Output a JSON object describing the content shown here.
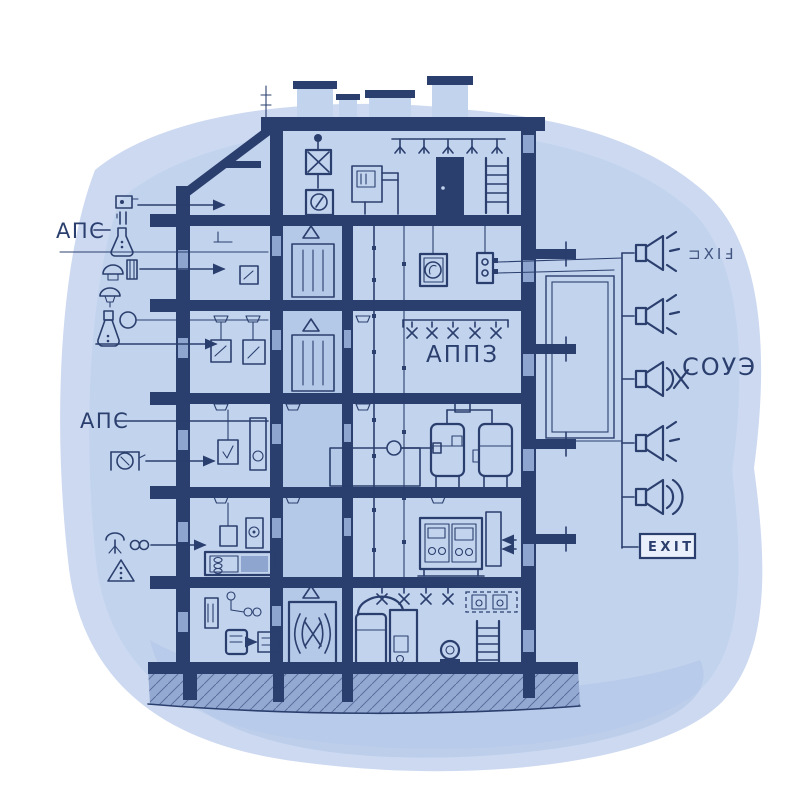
{
  "palette": {
    "paper": "#ffffff",
    "wash_outer": "#ccd9f1",
    "wash_inner": "#bfd1ec",
    "wash_deep": "#b2c6e7",
    "ink": "#2b3f6e",
    "room_fill": "#c2d3ee",
    "shaft_fill": "#b4c8e8",
    "ground_fill": "#93a9d2"
  },
  "legend_left": {
    "aps_top": {
      "label": "АПС"
    },
    "aps_mid": {
      "label": "АПС"
    },
    "icons": [
      {
        "name": "call-point-icon"
      },
      {
        "name": "flask-detector-icon"
      },
      {
        "name": "smoke-detector-icon"
      },
      {
        "name": "dome-detector-icon"
      },
      {
        "name": "flask-sampler-icon"
      },
      {
        "name": "pump-unit-icon"
      },
      {
        "name": "sprinkler-head-icon"
      },
      {
        "name": "warning-triangle-icon"
      }
    ]
  },
  "building": {
    "appz_room_label": "АППЗ",
    "floors": 6
  },
  "notification_side": {
    "fixe_label": "⊐XIℲ",
    "soue_label": "СОУЭ",
    "exit_label": "EXIT",
    "speakers": [
      {
        "name": "speaker-1",
        "waves": "rays"
      },
      {
        "name": "speaker-2",
        "waves": "rays"
      },
      {
        "name": "speaker-3",
        "waves": "arc-x"
      },
      {
        "name": "speaker-4",
        "waves": "rays"
      },
      {
        "name": "speaker-5",
        "waves": "arcs"
      }
    ]
  }
}
